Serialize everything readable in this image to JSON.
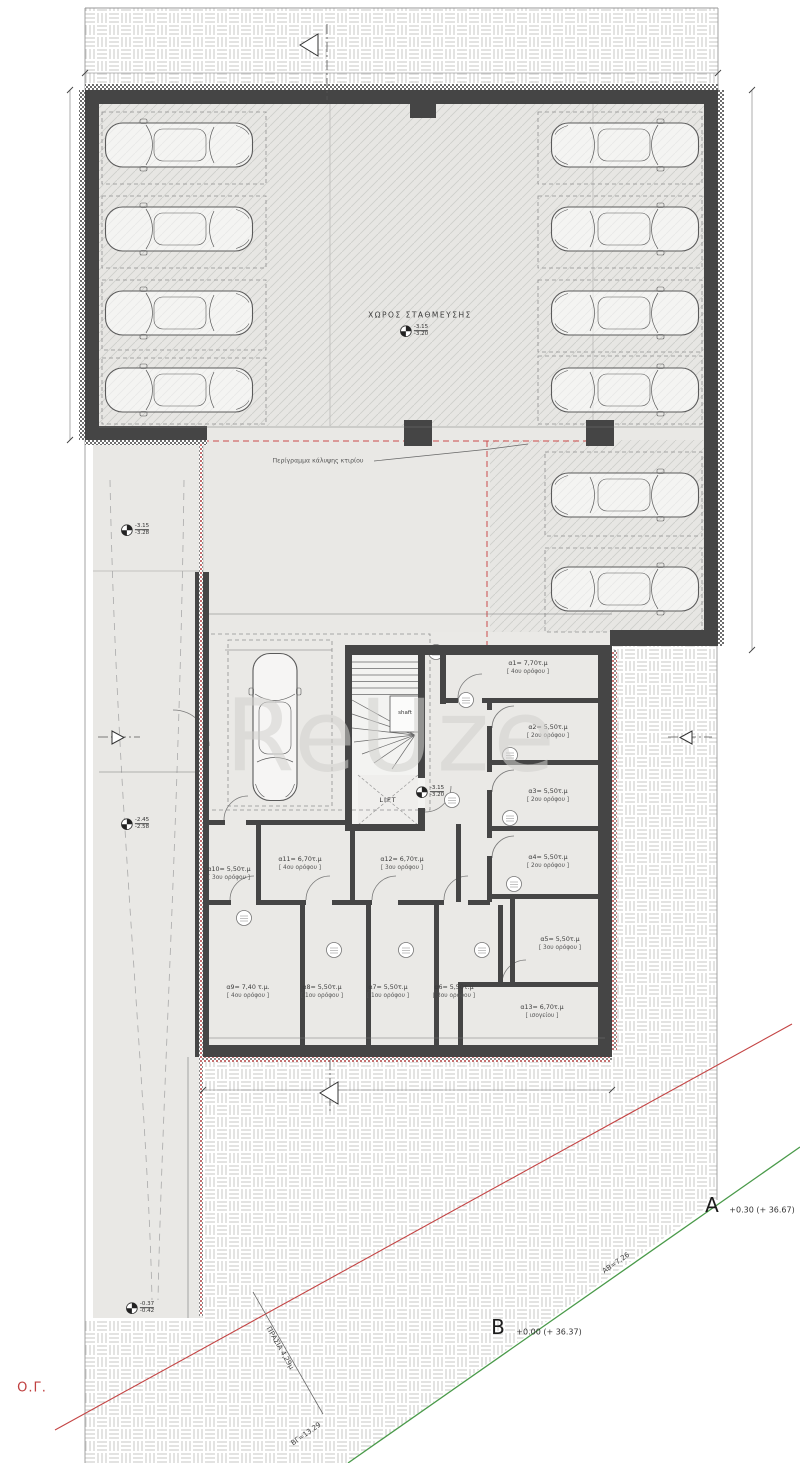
{
  "watermark": "ReUze",
  "garage": {
    "label": "ΧΩΡΟΣ ΣΤΑΘΜΕΥΣΗΣ"
  },
  "notes": {
    "perimeter": "Περίγραμμα κάλυψης κτιρίου",
    "shaft": "shaft",
    "lift": "LIFT"
  },
  "ramps": [
    {
      "t": "ράμπα με κλίση 10,07%",
      "x": 148,
      "y": 660
    },
    {
      "t": "ράμπα με κλίση 14,35%",
      "x": 148,
      "y": 1104
    }
  ],
  "spots": [
    {
      "n": "1",
      "x": 178,
      "y": 384
    },
    {
      "n": "2",
      "x": 178,
      "y": 308
    },
    {
      "n": "3",
      "x": 178,
      "y": 224
    },
    {
      "n": "4",
      "x": 178,
      "y": 140
    },
    {
      "n": "5",
      "x": 612,
      "y": 140
    },
    {
      "n": "6",
      "x": 612,
      "y": 224
    },
    {
      "n": "7",
      "x": 612,
      "y": 308
    },
    {
      "n": "8",
      "x": 612,
      "y": 384
    },
    {
      "n": "9",
      "x": 618,
      "y": 486
    },
    {
      "n": "10",
      "x": 624,
      "y": 580
    },
    {
      "n": "11",
      "x": 282,
      "y": 730
    }
  ],
  "rooms": [
    {
      "area": "α1= 7,70τ.μ",
      "floor": "[ 4ου ορόφου ]",
      "x": 528,
      "y": 668
    },
    {
      "area": "α2= 5,50τ.μ",
      "floor": "[ 2ου ορόφου ]",
      "x": 548,
      "y": 732
    },
    {
      "area": "α3= 5,50τ.μ",
      "floor": "[ 2ου ορόφου ]",
      "x": 548,
      "y": 796
    },
    {
      "area": "α4= 5,50τ.μ",
      "floor": "[ 2ου ορόφου ]",
      "x": 548,
      "y": 862
    },
    {
      "area": "α5= 5,50τ.μ",
      "floor": "[ 3ου ορόφου ]",
      "x": 560,
      "y": 944
    },
    {
      "area": "α13= 6,70τ.μ",
      "floor": "[ ισογείου ]",
      "x": 542,
      "y": 1012
    },
    {
      "area": "α12= 6,70τ.μ",
      "floor": "[ 3ου ορόφου ]",
      "x": 402,
      "y": 864
    },
    {
      "area": "α11= 6,70τ.μ",
      "floor": "[ 4ου ορόφου ]",
      "x": 300,
      "y": 864
    },
    {
      "area": "α10= 5,50τ.μ",
      "floor": "[ 3ου ορόφου ]",
      "x": 229,
      "y": 874
    },
    {
      "area": "α9= 7,40 τ.μ.",
      "floor": "[ 4ου ορόφου ]",
      "x": 248,
      "y": 992
    },
    {
      "area": "α8= 5,50τ.μ",
      "floor": "[ 1ου ορόφου ]",
      "x": 322,
      "y": 992
    },
    {
      "area": "α7= 5,50τ.μ",
      "floor": "[ 1ου ορόφου ]",
      "x": 388,
      "y": 992
    },
    {
      "area": "α6= 5,50τ.μ",
      "floor": "[ 3ου ορόφου ]",
      "x": 454,
      "y": 992
    }
  ],
  "dims": [
    {
      "t": "18.61",
      "x": 490,
      "y": 68
    },
    {
      "t": "10.00",
      "x": 64,
      "y": 262,
      "rot": -90
    },
    {
      "t": "-1.80 (+ 34.57)",
      "x": 32,
      "y": 183
    },
    {
      "t": "-1.15 (+ 35.22)",
      "x": 748,
      "y": 183
    },
    {
      "t": "15.95",
      "x": 754,
      "y": 368,
      "rot": -90
    },
    {
      "t": "9.90",
      "x": 333,
      "y": 265,
      "rot": -90
    },
    {
      "t": "15.60",
      "x": 310,
      "y": 372,
      "rot": -90
    },
    {
      "t": "17.86",
      "x": 406,
      "y": 420
    },
    {
      "t": "14.63",
      "x": 470,
      "y": 608
    },
    {
      "t": "5.55",
      "x": 590,
      "y": 540,
      "rot": -90
    },
    {
      "t": "ΗΑ=42.61",
      "x": 728,
      "y": 868,
      "rot": -90
    },
    {
      "t": "ΓΖ=54.07",
      "x": 76,
      "y": 878,
      "rot": -90
    },
    {
      "t": "3.90",
      "x": 145,
      "y": 764
    },
    {
      "t": "0.15",
      "x": 176,
      "y": 452,
      "rot": -90
    },
    {
      "t": "3.65",
      "x": 178,
      "y": 508,
      "rot": -90
    },
    {
      "t": "11.75",
      "x": 400,
      "y": 1077
    },
    {
      "t": "14.50",
      "x": 178,
      "y": 1063,
      "rot": -90
    },
    {
      "t": "4.00",
      "x": 276,
      "y": 658
    },
    {
      "t": "4.80",
      "x": 320,
      "y": 728,
      "rot": -90
    },
    {
      "t": "8.25",
      "x": 357,
      "y": 630,
      "rot": -90
    },
    {
      "t": "0.25",
      "x": 340,
      "y": 663
    },
    {
      "t": "1.80",
      "x": 385,
      "y": 663
    },
    {
      "t": "1.70",
      "x": 380,
      "y": 774
    },
    {
      "t": "1.50",
      "x": 442,
      "y": 776
    },
    {
      "t": "0.00",
      "x": 486,
      "y": 776
    },
    {
      "t": "1.75",
      "x": 354,
      "y": 795,
      "rot": -90
    },
    {
      "t": "2.00",
      "x": 434,
      "y": 848,
      "rot": -90
    },
    {
      "t": "1.50",
      "x": 228,
      "y": 818
    },
    {
      "t": "2.55",
      "x": 300,
      "y": 818
    },
    {
      "t": "3.30",
      "x": 410,
      "y": 843
    },
    {
      "t": "1.90",
      "x": 308,
      "y": 919,
      "rot": -90
    },
    {
      "t": "2.95",
      "x": 198,
      "y": 990,
      "rot": -90
    },
    {
      "t": "2.50",
      "x": 250,
      "y": 1030
    },
    {
      "t": "1.80",
      "x": 331,
      "y": 1030
    },
    {
      "t": "1.80",
      "x": 398,
      "y": 1030
    },
    {
      "t": "1.85",
      "x": 462,
      "y": 1030
    },
    {
      "t": "3.30",
      "x": 538,
      "y": 1033
    },
    {
      "t": "1.05",
      "x": 466,
      "y": 886
    },
    {
      "t": "2.30",
      "x": 552,
      "y": 886
    },
    {
      "t": "2.40",
      "x": 596,
      "y": 942,
      "rot": -90
    },
    {
      "t": "2.30",
      "x": 528,
      "y": 976
    },
    {
      "t": "4.05",
      "x": 530,
      "y": 651
    },
    {
      "t": "1.90",
      "x": 596,
      "y": 670,
      "rot": -90
    },
    {
      "t": "2.60",
      "x": 550,
      "y": 706
    },
    {
      "t": "1.85",
      "x": 594,
      "y": 798,
      "rot": -90
    },
    {
      "t": "6.08",
      "x": 620,
      "y": 956,
      "rot": -90
    },
    {
      "t": "δ = 2,50 + 0,05 X H = 3,20μ",
      "x": 148,
      "y": 846
    },
    {
      "t": "δ= 2,50 + 0,05 X H = 3,20μ",
      "x": 694,
      "y": 989
    }
  ],
  "levels": [
    {
      "top": "-3.15",
      "bottom": "-3.20",
      "x": 414,
      "y": 331
    },
    {
      "top": "-3.15",
      "bottom": "-3.28",
      "x": 135,
      "y": 530
    },
    {
      "top": "-2.45",
      "bottom": "-2.58",
      "x": 135,
      "y": 824
    },
    {
      "top": "-0.37",
      "bottom": "-0.42",
      "x": 140,
      "y": 1308
    },
    {
      "top": "-3.15",
      "bottom": "-3.20",
      "x": 430,
      "y": 792
    }
  ],
  "sections": [
    {
      "letter": "A",
      "x": 297,
      "y": 44
    },
    {
      "letter": "A",
      "x": 306,
      "y": 1093
    },
    {
      "letter": "B",
      "x": 112,
      "y": 722
    },
    {
      "letter": "B",
      "x": 692,
      "y": 722
    }
  ],
  "site": {
    "og": "Ο.Γ.",
    "a_name": "A",
    "a_value": "+0.30 (+ 36.67)",
    "b_name": "B",
    "b_value": "+0.00 (+ 36.37)",
    "ab": "ΑΒ=7.26",
    "vg": "ΒΓ=13.29",
    "prasia": "ΠΡΑΣΙΑ 4,29μ"
  },
  "colors": {
    "wall": "#454545",
    "red_line": "#c44444",
    "green_line": "#4a9a4a",
    "hatch_fill": "#e7e6e3"
  }
}
